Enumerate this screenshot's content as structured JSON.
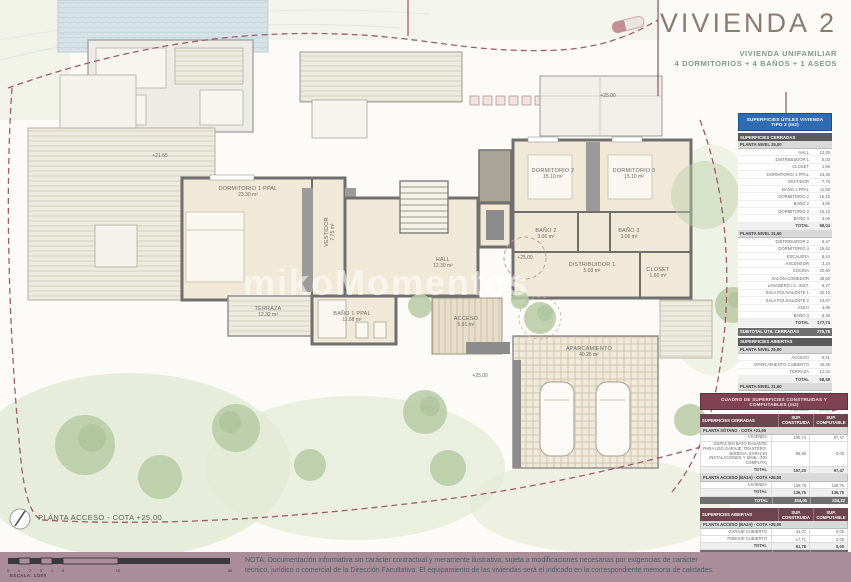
{
  "header": {
    "title": "VIVIENDA 2",
    "subtitle_1": "VIVIENDA UNIFAMILIAR",
    "subtitle_2": "4 DORMITORIOS + 4 BAÑOS +  1 ASEOS"
  },
  "watermark": "mikoMomentes",
  "plan_title": "PLANTA ACCESO - COTA +25,00",
  "plan": {
    "rooms": [
      {
        "label": "DORMITORIO 1 PPAL",
        "area": "23.30 m²",
        "x": 248,
        "y": 192
      },
      {
        "label": "VESTIDOR",
        "area": "7.75 m²",
        "x": 330,
        "y": 232,
        "vertical": true
      },
      {
        "label": "HALL",
        "area": "12.30 m²",
        "x": 443,
        "y": 263
      },
      {
        "label": "DORMITORIO 2",
        "area": "15.10 m²",
        "x": 553,
        "y": 174
      },
      {
        "label": "DORMITORIO 3",
        "area": "15.10 m²",
        "x": 634,
        "y": 174
      },
      {
        "label": "BAÑO 2",
        "area": "3.06 m²",
        "x": 546,
        "y": 234
      },
      {
        "label": "BAÑO 3",
        "area": "3.06 m²",
        "x": 629,
        "y": 234
      },
      {
        "label": "DISTRIBUIDOR 1",
        "area": "5.03 m²",
        "x": 592,
        "y": 268
      },
      {
        "label": "CLOSET",
        "area": "1.66 m²",
        "x": 658,
        "y": 273
      },
      {
        "label": "TERRAZA",
        "area": "12.32 m²",
        "x": 268,
        "y": 312
      },
      {
        "label": "BAÑO 1 PPAL",
        "area": "11.68 m²",
        "x": 352,
        "y": 317
      },
      {
        "label": "ACCESO",
        "area": "5.91 m²",
        "x": 466,
        "y": 322
      },
      {
        "label": "APARCAMIENTO",
        "area": "40.26 m²",
        "x": 589,
        "y": 352
      }
    ],
    "levels": [
      {
        "text": "+21.65",
        "x": 160,
        "y": 156
      },
      {
        "text": "+25.00",
        "x": 608,
        "y": 96
      },
      {
        "text": "+25.00",
        "x": 525,
        "y": 258
      },
      {
        "text": "+25.00",
        "x": 480,
        "y": 376
      }
    ]
  },
  "areas_table": {
    "title": "SUPERFICIES ÚTILES VIVIENDA TIPO 2 (m2)",
    "groups": [
      {
        "name": "SUPERFICIES CERRADAS",
        "levels": [
          {
            "name": "PLANTA NIVEL 25,00",
            "rows": [
              [
                "HALL",
                "12,30"
              ],
              [
                "DISTRIBUIDOR 1",
                "5,03"
              ],
              [
                "CLOSET",
                "1,66"
              ],
              [
                "DORMITORIO 1 PPAL",
                "23,30"
              ],
              [
                "VESTIDOR",
                "7,75"
              ],
              [
                "BAÑO 1 PPAL",
                "11,68"
              ],
              [
                "DORMITORIO 2",
                "15,10"
              ],
              [
                "BAÑO 2",
                "3,06"
              ],
              [
                "DORMITORIO 3",
                "15,10"
              ],
              [
                "BAÑO 3",
                "3,06"
              ]
            ],
            "total_label": "TOTAL",
            "total": "98,04"
          },
          {
            "name": "PLANTA NIVEL 21,60",
            "rows": [
              [
                "DISTRIBUIDOR 2",
                "8,47"
              ],
              [
                "DORMITORIO 4",
                "16,52"
              ],
              [
                "ESCALERA",
                "6,44"
              ],
              [
                "ASCENSOR",
                "3,24"
              ],
              [
                "COCINA",
                "20,60"
              ],
              [
                "SALÓN-COMEDOR",
                "48,60"
              ],
              [
                "LAVADERO / C. INST.",
                "6,27"
              ],
              [
                "SALA POLIVALENTE 1",
                "32,10"
              ],
              [
                "SALA POLIVALENTE 2",
                "24,07"
              ],
              [
                "ASEO",
                "4,95"
              ],
              [
                "BAÑO 4",
                "6,48"
              ]
            ],
            "total_label": "TOTAL",
            "total": "177,74"
          }
        ],
        "subtotal_label": "SUBTOTAL ÚTIL CERRADAS",
        "subtotal": "275,78"
      },
      {
        "name": "SUPERFICIES ABIERTAS",
        "levels": [
          {
            "name": "PLANTA NIVEL 25,00",
            "rows": [
              [
                "ACCESO",
                "5,91"
              ],
              [
                "APARCAMIENTO CUBIERTO",
                "40,26"
              ],
              [
                "TERRAZA",
                "12,32"
              ]
            ],
            "total_label": "TOTAL",
            "total": "58,49"
          },
          {
            "name": "PLANTA NIVEL 21,60",
            "rows": [
              [
                "PATIO INGLÉS 1",
                "11,40"
              ],
              [
                "PATIO INGLÉS 2",
                "14,00"
              ],
              [
                "PORCHE",
                "29,50"
              ],
              [
                "PORCHE PATIO",
                "6,80"
              ]
            ],
            "total_label": "TOTAL",
            "total": "61,70"
          }
        ],
        "subtotal_label": "SUBTOTAL ÚTIL ABIERTAS",
        "subtotal": "120,19"
      }
    ],
    "grand_label": "TOTAL SUPERFICIE ÚTIL",
    "grand": "395,97"
  },
  "built_table": {
    "title": "CUADRO DE SUPERFICIES CONSTRUIDAS Y COMPUTABLES (m2)",
    "col_headers": [
      "SUP. CONSTRUIDA",
      "SUP. COMPUTABLE"
    ],
    "blocks": [
      {
        "name": "SUPERFICIES CERRADAS",
        "levels": [
          {
            "name": "PLANTA SÓTANO - COTA +21,60",
            "rows": [
              [
                "VIVIENDA",
                "100,74",
                "97,47"
              ],
              [
                "ESPACIOS BAJO RASANTE PARA USO GARAJE, TRASTERO, BODEGA, ESPACIO INSTALACIONES Y SIMIL. (NO COMPUTA)",
                "96,56",
                "0,00"
              ]
            ],
            "total_label": "TOTAL",
            "total": [
              "197,30",
              "97,47"
            ]
          },
          {
            "name": "PLANTA ACCESO (BAJA) - COTA +25,00",
            "rows": [
              [
                "VIVIENDA",
                "136,75",
                "136,75"
              ]
            ],
            "total_label": "TOTAL",
            "total": [
              "136,75",
              "136,75"
            ]
          }
        ],
        "block_total_label": "TOTAL",
        "block_total": [
          "334,05",
          "234,22"
        ]
      },
      {
        "name": "SUPERFICIES ABIERTAS",
        "levels": [
          {
            "name": "PLANTA ACCESO (BAJA) - COTA +25,00",
            "rows": [
              [
                "GARAJE CUBIERTO",
                "44,07",
                "0,00"
              ],
              [
                "PORCHE CUBIERTO",
                "17,71",
                "0,00"
              ]
            ],
            "total_label": "TOTAL",
            "total": [
              "61,78",
              "0,00"
            ]
          }
        ],
        "block_total_label": "TOTAL",
        "block_total": [
          "61,78",
          "0,00"
        ]
      }
    ],
    "grand_label": "TOTAL SUPERFICIE",
    "grand": [
      "395,83",
      "234,22"
    ],
    "footnotes": [
      "Superficies construidas con parte proporcional de elementos comunes, medidas según criterios de la normativa vigente.",
      "El cómputo de edificabilidad se ajusta a la normativa urbanística de aplicación."
    ]
  },
  "scalebar": {
    "ticks": [
      "0",
      "1",
      "2",
      "3",
      "4",
      "5",
      "10",
      "20"
    ],
    "label": "ESCALA: 1/200"
  },
  "note": {
    "line1": "NOTA: Documentación informativa sin carácter contractual y meramente ilustrativa, sujeta a modificaciones necesarias por exigencias de carácter",
    "line2": "técnico, jurídico o comercial de la Dirección Facultativa. El equipamiento de las viviendas será el indicado en la correspondiente memoria de calidades."
  },
  "colors": {
    "accent_blue": "#2f6cb3",
    "accent_maroon": "#7e4254",
    "boundary": "#a2596b",
    "bottom_bar": "#ab8d99",
    "room_fill": "#f1e9d8"
  }
}
